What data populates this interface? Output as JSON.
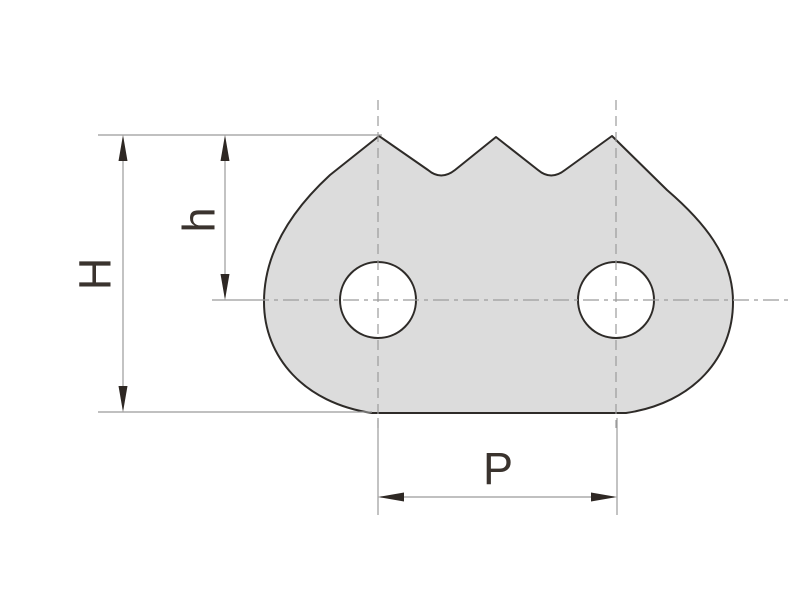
{
  "drawing": {
    "kind": "technical-dimension-drawing",
    "part": "toothed chain link plate",
    "teeth_count": 3,
    "holes_count": 2
  },
  "labels": {
    "H": "H",
    "h": "h",
    "P": "P"
  },
  "dimensions": [
    {
      "name": "overall-height",
      "label": "H",
      "orientation": "vertical"
    },
    {
      "name": "tooth-height-to-hole-center",
      "label": "h",
      "orientation": "vertical"
    },
    {
      "name": "pitch-between-hole-centers",
      "label": "P",
      "orientation": "horizontal"
    }
  ],
  "colors": {
    "background": "#ffffff",
    "plate_fill": "#dcdcdc",
    "outline": "#2e2b28",
    "thin_line": "#9b9b9b",
    "arrow": "#2e2824",
    "label": "#3a332e"
  }
}
